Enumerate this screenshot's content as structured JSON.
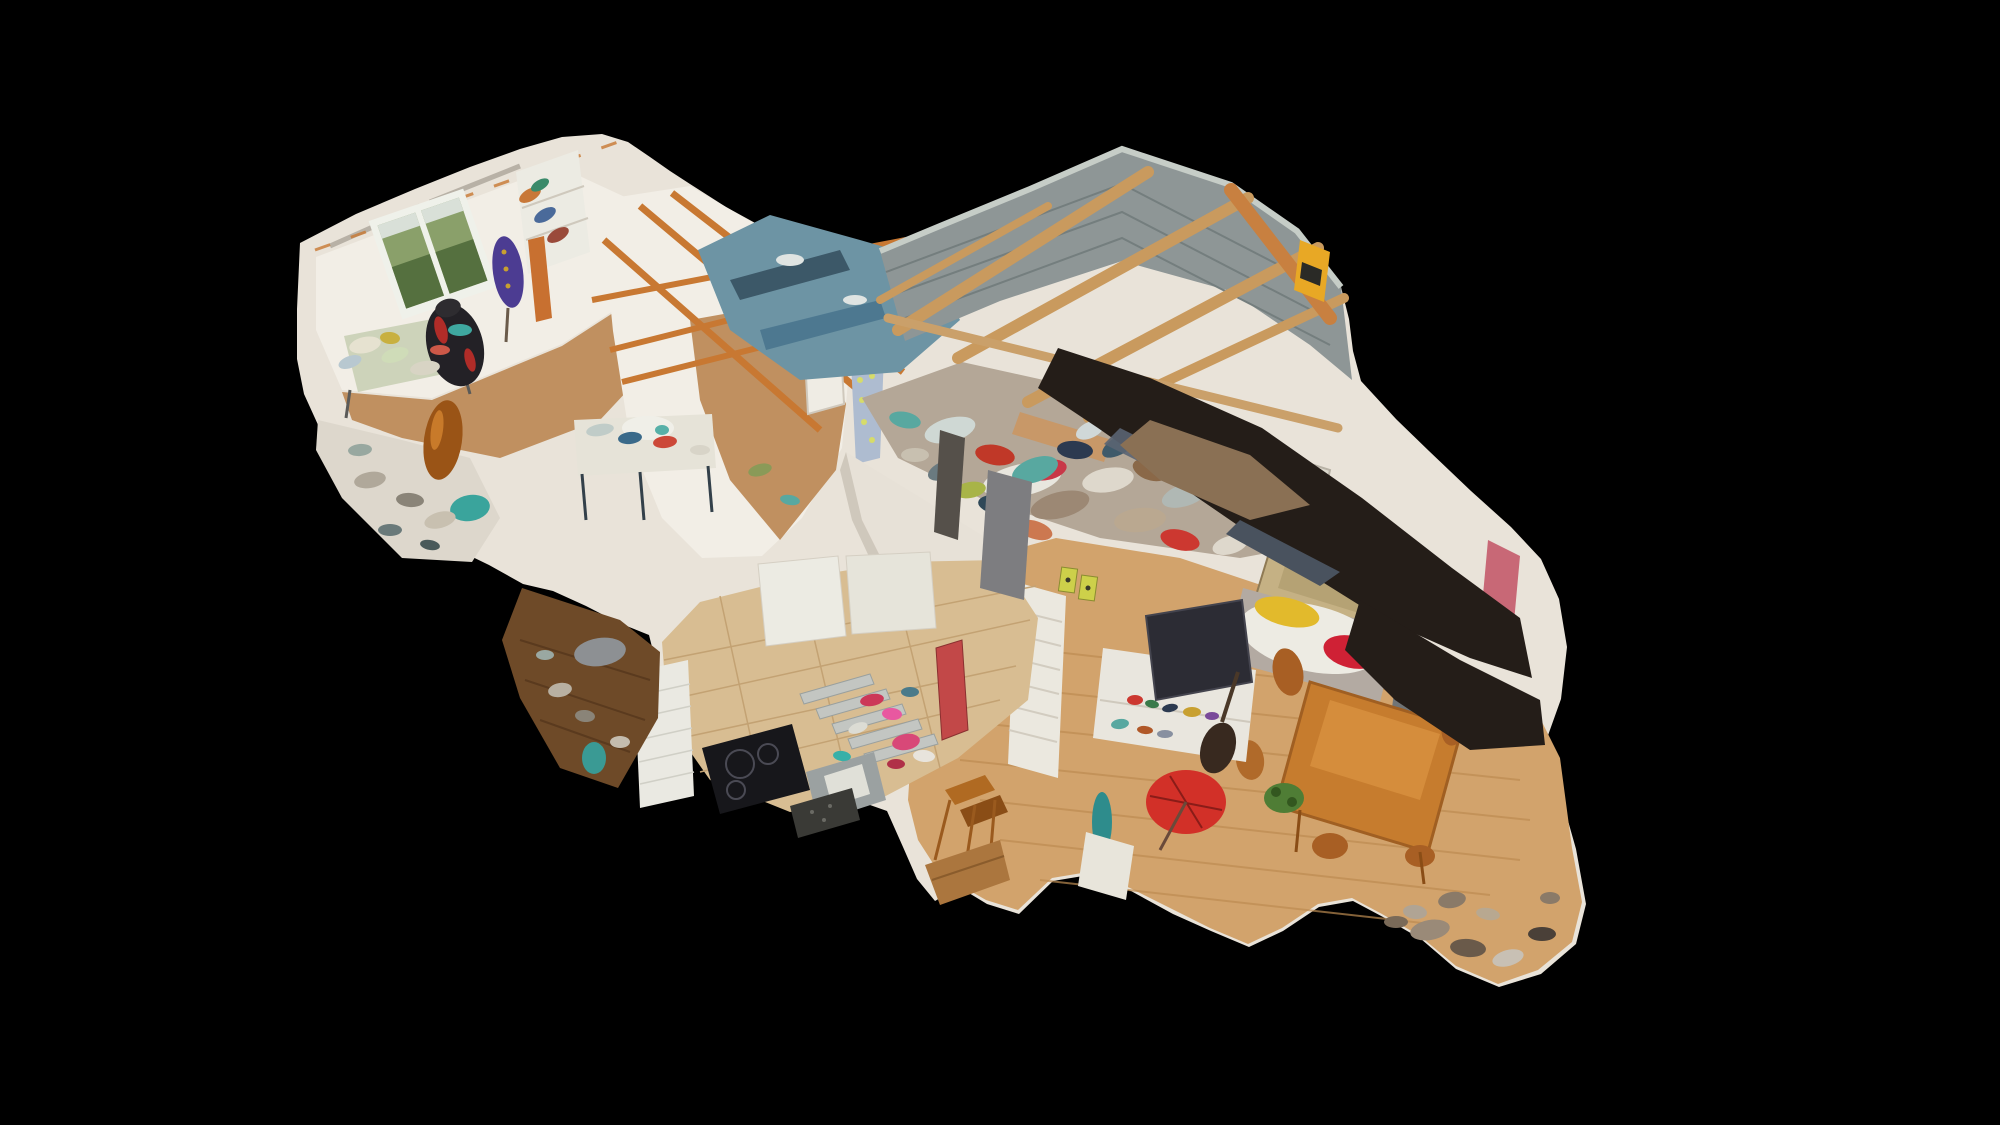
{
  "scene": {
    "description": "3D dollhouse cutaway scan of a two-storey house viewed from above on a black background; no UI chrome visible",
    "background": "#000000",
    "palette": {
      "wall": "#e9e3d9",
      "wallBright": "#f2eee6",
      "wallShade": "#cfc8bc",
      "cutBand": "#ddd7cc",
      "rafterOrange": "#c87832",
      "rafterTan": "#c99a5e",
      "beamOrange": "#c88040",
      "cinder": "#8e9696",
      "cinderDark": "#747e7e",
      "cinderCap": "#c6cdc7",
      "tarpBlue": "#6d94a4",
      "tarpDark": "#3c5868",
      "woodFloorLight": "#d2a36c",
      "woodPlank": "#bd8c52",
      "woodFloorMid": "#c09060",
      "woodDark": "#6e4a28",
      "tile": "#d8bd92",
      "tileGrout": "#c3a273",
      "darkBlob": "#241d18",
      "blobBrown": "#8a7054",
      "gloss": "#5a6472",
      "sofaGray": "#b3aaa2",
      "duvet": "#edebe3",
      "blanketYellow": "#e2ba2c",
      "pillowRed": "#cf2135",
      "pine": "#c67c2e",
      "pineLight": "#e09a46",
      "chairWood": "#a85f24",
      "tvDark": "#2c2c34",
      "standWhite": "#e9e6de",
      "parasolRed": "#d23028",
      "bottleTeal": "#2e8c8c",
      "plantGreen": "#4f7d35",
      "mannequinPurple": "#4c3c92",
      "chairBlack": "#232126",
      "chairRed": "#b02c28",
      "amber": "#9a5416",
      "tealFabric": "#3aa49c",
      "windowGreen": "#8aa06a",
      "windowGreenDark": "#55703f",
      "windowSky": "#d9e0d8",
      "frame": "#eff1ea",
      "cooktop": "#17171b",
      "stairTread": "#c3c6c2",
      "sink": "#9ba1a1",
      "basin": "#e0e0d8",
      "doorRed": "#c24848",
      "boxYellow": "#e8a825",
      "elecBox": "#cdd04a",
      "board": "#aebcd0",
      "brick": "#eae9e2"
    },
    "regions": [
      {
        "name": "sewing-room",
        "note": "upper-left room: garden window, purple dress form, shelves, gaming chair, desk"
      },
      {
        "name": "craft-landing",
        "note": "center mezzanine: sewing-machine table, ironing board, white door, arch"
      },
      {
        "name": "garage-workshop",
        "note": "upper-right: cinder-block walls, tan rafters, blue tarps, dense clutter, yellow box"
      },
      {
        "name": "living-dining-room",
        "note": "lower-right: oak floor, sofa with yellow and red blankets, pine table, TV unit, red parasol"
      },
      {
        "name": "kitchen",
        "note": "lower-center: beige tiles, cooktop, sink, staircase, red door"
      },
      {
        "name": "snug-lounge",
        "note": "lower-left: dark wood floor room"
      },
      {
        "name": "scan-artifacts",
        "note": "dark glossy roof-scan blobs sweeping across the right side"
      }
    ],
    "clutter": {
      "clutter-sewing": [
        [
          365,
          345,
          16,
          8,
          -12,
          "#e6e2d0"
        ],
        [
          395,
          355,
          14,
          7,
          -18,
          "#cfdcb8"
        ],
        [
          425,
          368,
          15,
          7,
          -8,
          "#d8d4c4"
        ],
        [
          390,
          338,
          10,
          6,
          5,
          "#c8b040"
        ],
        [
          350,
          362,
          12,
          6,
          -20,
          "#b8c8d0"
        ],
        [
          440,
          350,
          10,
          5,
          0,
          "#cc5848"
        ],
        [
          530,
          195,
          12,
          6,
          -30,
          "#c87838"
        ],
        [
          545,
          215,
          12,
          6,
          -30,
          "#4a6a9a"
        ],
        [
          558,
          235,
          12,
          6,
          -30,
          "#9a4a3a"
        ],
        [
          540,
          185,
          10,
          5,
          -30,
          "#3a8a6a"
        ],
        [
          460,
          330,
          12,
          6,
          0,
          "#3fa8a0"
        ]
      ],
      "clutter-lowleft": [
        [
          370,
          480,
          16,
          8,
          -10,
          "#b0a89a"
        ],
        [
          410,
          500,
          14,
          7,
          5,
          "#8a8478"
        ],
        [
          440,
          520,
          16,
          8,
          -15,
          "#c8c0b0"
        ],
        [
          390,
          530,
          12,
          6,
          0,
          "#6a7a7a"
        ],
        [
          430,
          545,
          10,
          5,
          10,
          "#4a5a5a"
        ],
        [
          360,
          450,
          12,
          6,
          -5,
          "#98a8a0"
        ]
      ],
      "clutter-landing": [
        [
          600,
          430,
          14,
          6,
          -10,
          "#c0ccc8"
        ],
        [
          630,
          438,
          12,
          6,
          -6,
          "#3a6a8a"
        ],
        [
          665,
          442,
          12,
          6,
          -6,
          "#cc4838"
        ],
        [
          700,
          450,
          10,
          5,
          0,
          "#d8d4c8"
        ],
        [
          760,
          470,
          12,
          6,
          -15,
          "#8a9a58"
        ],
        [
          790,
          500,
          10,
          5,
          10,
          "#58a8a0"
        ]
      ],
      "clutter-garage": [
        [
          950,
          430,
          26,
          12,
          -15,
          "#cfd8d4"
        ],
        [
          995,
          455,
          20,
          10,
          10,
          "#c03828"
        ],
        [
          1035,
          470,
          24,
          12,
          -20,
          "#58a8a0"
        ],
        [
          1075,
          450,
          18,
          9,
          5,
          "#2c3a50"
        ],
        [
          1108,
          480,
          26,
          12,
          -10,
          "#ded8cc"
        ],
        [
          1150,
          470,
          18,
          10,
          20,
          "#8a6848"
        ],
        [
          1185,
          495,
          24,
          11,
          -18,
          "#b0b8b4"
        ],
        [
          1220,
          480,
          16,
          8,
          0,
          "#cc6a28"
        ],
        [
          1255,
          505,
          22,
          10,
          -12,
          "#4a5a68"
        ],
        [
          1290,
          490,
          18,
          9,
          15,
          "#ded8cc"
        ],
        [
          1315,
          520,
          16,
          8,
          -8,
          "#8a6848"
        ],
        [
          1060,
          505,
          30,
          13,
          -14,
          "#9c8874"
        ],
        [
          1000,
          505,
          22,
          10,
          8,
          "#2f4858"
        ],
        [
          945,
          470,
          18,
          9,
          -22,
          "#6a7a80"
        ],
        [
          905,
          420,
          16,
          8,
          12,
          "#58a8a0"
        ],
        [
          1140,
          520,
          26,
          12,
          -6,
          "#baa890"
        ],
        [
          1180,
          540,
          20,
          10,
          14,
          "#cc3830"
        ],
        [
          1230,
          545,
          18,
          9,
          -16,
          "#ded8cc"
        ],
        [
          915,
          455,
          14,
          7,
          0,
          "#c8c0b0"
        ],
        [
          1090,
          430,
          15,
          8,
          -25,
          "#d0d8d8"
        ],
        [
          1270,
          460,
          20,
          9,
          -5,
          "#7a8890"
        ],
        [
          1035,
          530,
          18,
          9,
          18,
          "#cc7850"
        ],
        [
          970,
          490,
          16,
          8,
          -10,
          "#a8b448"
        ],
        [
          1305,
          555,
          22,
          10,
          -14,
          "#8a7a62"
        ],
        [
          1120,
          445,
          20,
          9,
          -30,
          "#3f5a6a"
        ]
      ],
      "clutter-living": [
        [
          1135,
          700,
          8,
          5,
          0,
          "#cc3830"
        ],
        [
          1152,
          704,
          7,
          4,
          10,
          "#3a7a4a"
        ],
        [
          1170,
          708,
          8,
          4,
          -10,
          "#2c3a50"
        ],
        [
          1192,
          712,
          9,
          5,
          0,
          "#c8a030"
        ],
        [
          1212,
          716,
          7,
          4,
          0,
          "#7a4a9a"
        ],
        [
          1120,
          724,
          9,
          5,
          -8,
          "#58a8a0"
        ],
        [
          1145,
          730,
          8,
          4,
          6,
          "#b05828"
        ],
        [
          1165,
          734,
          8,
          4,
          0,
          "#8890a0"
        ],
        [
          1268,
          488,
          5,
          4,
          0,
          "#c83830"
        ],
        [
          1280,
          492,
          5,
          4,
          0,
          "#3a8a4a"
        ],
        [
          1292,
          496,
          5,
          4,
          0,
          "#2c5a9a"
        ],
        [
          1304,
          500,
          5,
          4,
          0,
          "#e0c030"
        ],
        [
          1276,
          500,
          4,
          3,
          0,
          "#d87828"
        ],
        [
          1296,
          488,
          4,
          3,
          0,
          "#7a3a8a"
        ],
        [
          1452,
          900,
          14,
          8,
          -10,
          "#8a7a68"
        ],
        [
          1415,
          912,
          12,
          7,
          6,
          "#b0a494"
        ]
      ],
      "clutter-kitchen": [
        [
          872,
          700,
          12,
          6,
          -10,
          "#cc3858"
        ],
        [
          892,
          714,
          10,
          6,
          5,
          "#e858a0"
        ],
        [
          858,
          728,
          10,
          5,
          -20,
          "#dcdcd4"
        ],
        [
          910,
          692,
          9,
          5,
          0,
          "#4a7a8a"
        ],
        [
          842,
          756,
          9,
          5,
          8,
          "#38b0a8"
        ],
        [
          906,
          742,
          14,
          8,
          -10,
          "#d84878"
        ],
        [
          924,
          756,
          11,
          6,
          5,
          "#e8e4dc"
        ],
        [
          896,
          764,
          9,
          5,
          0,
          "#b03048"
        ]
      ],
      "clutter-snug": [
        [
          560,
          690,
          12,
          7,
          -10,
          "#b8b0a2"
        ],
        [
          585,
          716,
          10,
          6,
          5,
          "#8a8478"
        ],
        [
          620,
          742,
          10,
          6,
          0,
          "#c4bcae"
        ],
        [
          545,
          655,
          9,
          5,
          0,
          "#9aa8a2"
        ]
      ],
      "clutter-bottomright": [
        [
          1430,
          930,
          20,
          10,
          -10,
          "#9a8a78"
        ],
        [
          1468,
          948,
          18,
          9,
          5,
          "#6a5a4a"
        ],
        [
          1508,
          958,
          16,
          8,
          -15,
          "#c8c0b4"
        ],
        [
          1542,
          934,
          14,
          7,
          0,
          "#4a4038"
        ],
        [
          1488,
          914,
          12,
          6,
          10,
          "#b8a890"
        ],
        [
          1550,
          898,
          10,
          6,
          0,
          "#8a7a68"
        ],
        [
          1396,
          922,
          12,
          6,
          0,
          "#7a6a58"
        ]
      ]
    }
  }
}
